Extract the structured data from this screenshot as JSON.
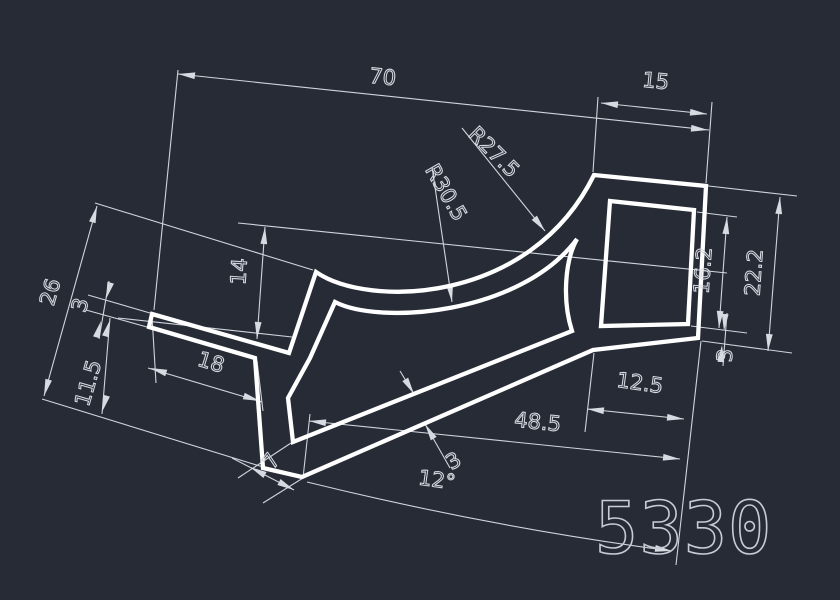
{
  "drawing": {
    "part_number": "5330",
    "background_color": "#262b35",
    "profile_line_color": "#ffffff",
    "dimension_color": "#d6dae1",
    "dims": {
      "total_width": "70",
      "head_top_width": "15",
      "radius_outer": "R27.5",
      "radius_inner": "R30.5",
      "shoulder_drop": "14",
      "left_height": "26",
      "arm_thickness": "3",
      "arm_to_tip": "11.5",
      "arm_length": "18",
      "head_inner_height": "16.2",
      "head_outer_height": "22.2",
      "head_wall_thickness": "3",
      "head_bottom_width": "12.5",
      "strut_length": "48.5",
      "strut_thickness": "3",
      "tip_width": "7",
      "tilt_angle": "12°"
    }
  }
}
